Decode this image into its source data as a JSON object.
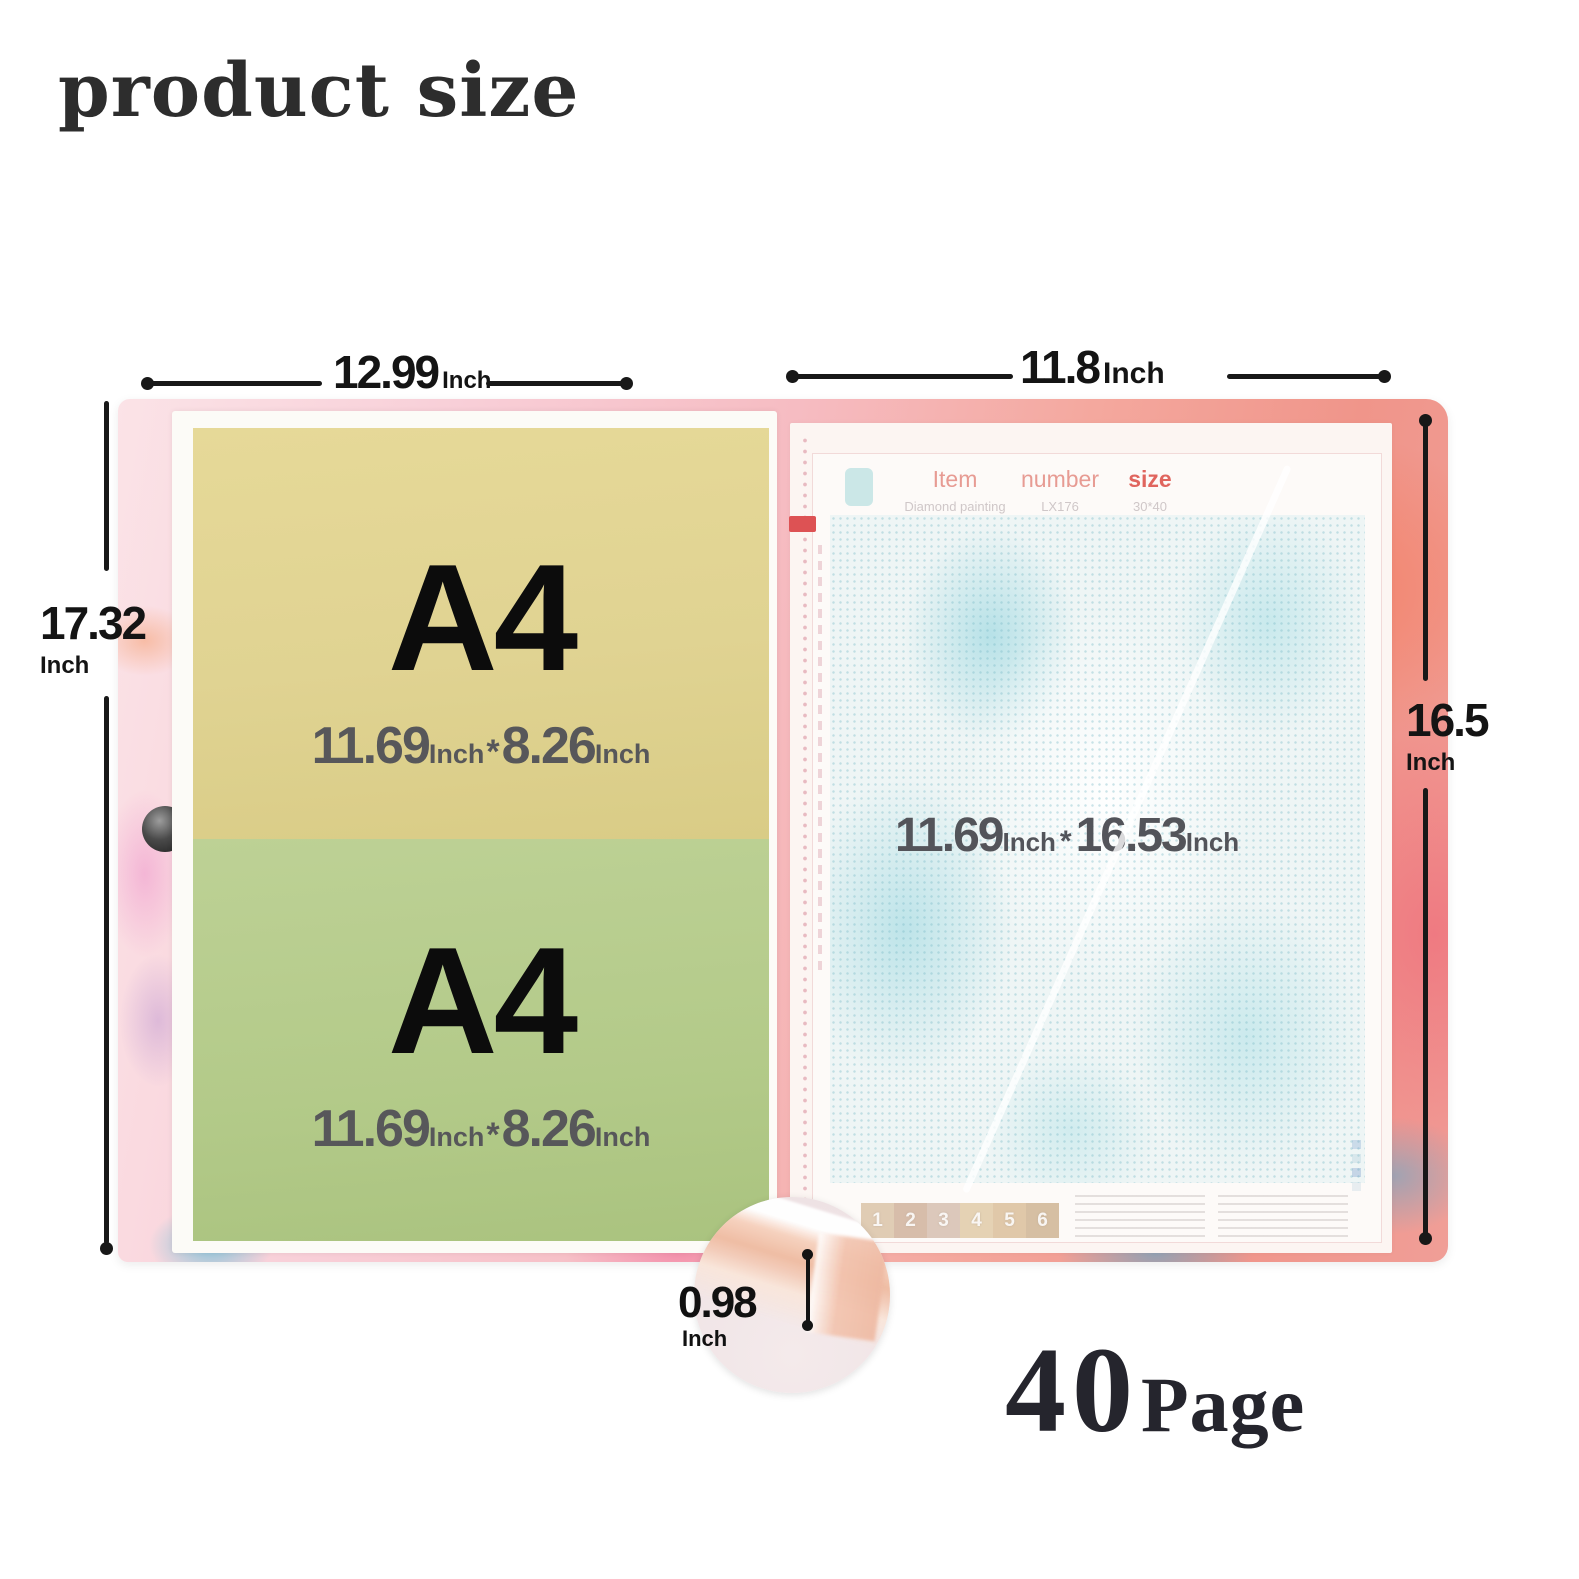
{
  "title": "product size",
  "dimensions": {
    "top_left": {
      "value": "12.99",
      "unit": "Inch"
    },
    "top_right": {
      "value": "11.8",
      "unit": "Inch"
    },
    "left": {
      "value": "17.32",
      "unit": "Inch"
    },
    "right": {
      "value": "16.5",
      "unit": "Inch"
    },
    "spine": {
      "value": "0.98",
      "unit": "Inch"
    }
  },
  "left_page": {
    "top_sheet": {
      "label": "A4",
      "w": "11.69",
      "wu": "Inch",
      "sep": "*",
      "h": "8.26",
      "hu": "Inch"
    },
    "bottom_sheet": {
      "label": "A4",
      "w": "11.69",
      "wu": "Inch",
      "sep": "*",
      "h": "8.26",
      "hu": "Inch"
    }
  },
  "right_page": {
    "header": {
      "col1": "Item",
      "col2": "number",
      "col3": "size"
    },
    "header_values": {
      "item": "Diamond painting",
      "number": "LX176",
      "size": "30*40"
    },
    "canvas_dim": {
      "w": "11.69",
      "wu": "Inch",
      "sep": "*",
      "h": "16.53",
      "hu": "Inch"
    },
    "swatches": [
      "1",
      "2",
      "3",
      "4",
      "5",
      "6"
    ]
  },
  "page_count": {
    "number": "40",
    "label": "Page"
  },
  "colors": {
    "cover_pink": "#f6bcc2",
    "cover_coral": "#f0958a",
    "cover_teal": "#3db7d4",
    "sheet_yellow": "#e0d392",
    "sheet_green": "#b3ca89",
    "canvas_teal": "#bfe3e8",
    "measure_line": "#181818",
    "header_pink": "#e79b93",
    "spine_rosegold": "#efbda4"
  }
}
